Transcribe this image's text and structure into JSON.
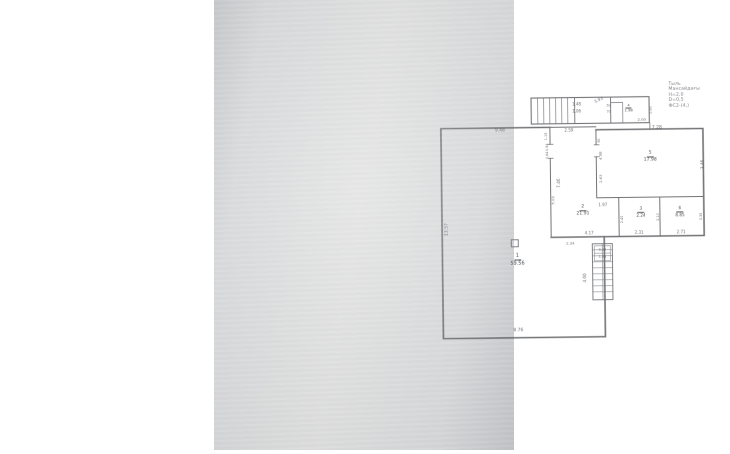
{
  "colors": {
    "paper": "#d7d8da",
    "line": "#55565a",
    "text": "#54555a",
    "canvas": "#ffffff"
  },
  "title_block": {
    "lines": [
      "Тыль",
      "Мансайдағы",
      "Н=2,0",
      "D=0,5",
      "ФС2-(4,)"
    ]
  },
  "rooms": [
    {
      "number": "1",
      "area": "59.56",
      "x": 303,
      "y": 259,
      "size": 5
    },
    {
      "number": "2",
      "area": "21.91",
      "x": 369,
      "y": 211,
      "size": 4.5
    },
    {
      "number": "3",
      "area": "2.24",
      "x": 427,
      "y": 213,
      "size": 4.2
    },
    {
      "number": "4",
      "area": "1.98",
      "x": 416,
      "y": 109,
      "size": 3.8
    },
    {
      "number": "5",
      "area": "17.98",
      "x": 437,
      "y": 158,
      "size": 4.5
    },
    {
      "number": "6",
      "area": "8.85",
      "x": 466,
      "y": 213,
      "size": 4.2
    }
  ],
  "dimensions": [
    {
      "text": "9.48",
      "x": 287,
      "y": 130
    },
    {
      "text": "2.59",
      "x": 356,
      "y": 130,
      "size": 4
    },
    {
      "text": "7.28",
      "x": 444,
      "y": 129
    },
    {
      "text": "5.93",
      "x": 386,
      "y": 100,
      "rot": -25,
      "size": 4
    },
    {
      "text": "1.48",
      "x": 364,
      "y": 104,
      "size": 4
    },
    {
      "text": "1.06",
      "x": 364,
      "y": 111,
      "size": 4
    },
    {
      "text": "50",
      "x": 396,
      "y": 106,
      "size": 3.4
    },
    {
      "text": "70",
      "x": 396,
      "y": 112,
      "size": 3.4
    },
    {
      "text": "2.00",
      "x": 429,
      "y": 120,
      "size": 3.8
    },
    {
      "text": "0.90",
      "x": 438,
      "y": 111,
      "rot": -90,
      "size": 3.4
    },
    {
      "text": "1.19",
      "x": 333,
      "y": 136,
      "rot": -90,
      "size": 3.4
    },
    {
      "text": "0.94",
      "x": 334,
      "y": 147,
      "rot": -90,
      "size": 3.4
    },
    {
      "text": "0.64",
      "x": 334,
      "y": 155,
      "rot": -90,
      "size": 3.4
    },
    {
      "text": "7.46",
      "x": 345,
      "y": 183,
      "rot": -90,
      "size": 4.2
    },
    {
      "text": "5.03",
      "x": 339,
      "y": 200,
      "rot": -90,
      "size": 3.8
    },
    {
      "text": "90",
      "x": 386,
      "y": 141,
      "rot": -90,
      "size": 3.2
    },
    {
      "text": "4.98",
      "x": 387,
      "y": 156,
      "rot": -90,
      "size": 3.8
    },
    {
      "text": "2.63",
      "x": 387,
      "y": 179,
      "rot": -90,
      "size": 3.8
    },
    {
      "text": "3.46",
      "x": 489,
      "y": 166,
      "rot": -90,
      "size": 4.2
    },
    {
      "text": "1.97",
      "x": 389,
      "y": 205,
      "size": 4
    },
    {
      "text": "2.40",
      "x": 408,
      "y": 220,
      "rot": -90,
      "size": 3.4
    },
    {
      "text": "2.10",
      "x": 444,
      "y": 218,
      "rot": -90,
      "size": 3.4
    },
    {
      "text": "3.35",
      "x": 487,
      "y": 218,
      "rot": -90,
      "size": 3.4
    },
    {
      "text": "4.17",
      "x": 375,
      "y": 233,
      "size": 4
    },
    {
      "text": "2.31",
      "x": 425,
      "y": 233,
      "size": 4
    },
    {
      "text": "2.71",
      "x": 467,
      "y": 233,
      "size": 4
    },
    {
      "text": "2.34",
      "x": 356,
      "y": 243,
      "size": 3.8
    },
    {
      "text": "0.24",
      "x": 388,
      "y": 250,
      "size": 3.4
    },
    {
      "text": "1.98",
      "x": 388,
      "y": 257,
      "size": 3.4
    },
    {
      "text": "4.60",
      "x": 370,
      "y": 278,
      "rot": -90,
      "size": 4.2
    },
    {
      "text": "13.57",
      "x": 233,
      "y": 228,
      "rot": -90,
      "size": 4.5
    },
    {
      "text": "8.76",
      "x": 303,
      "y": 330,
      "size": 4.5
    }
  ]
}
